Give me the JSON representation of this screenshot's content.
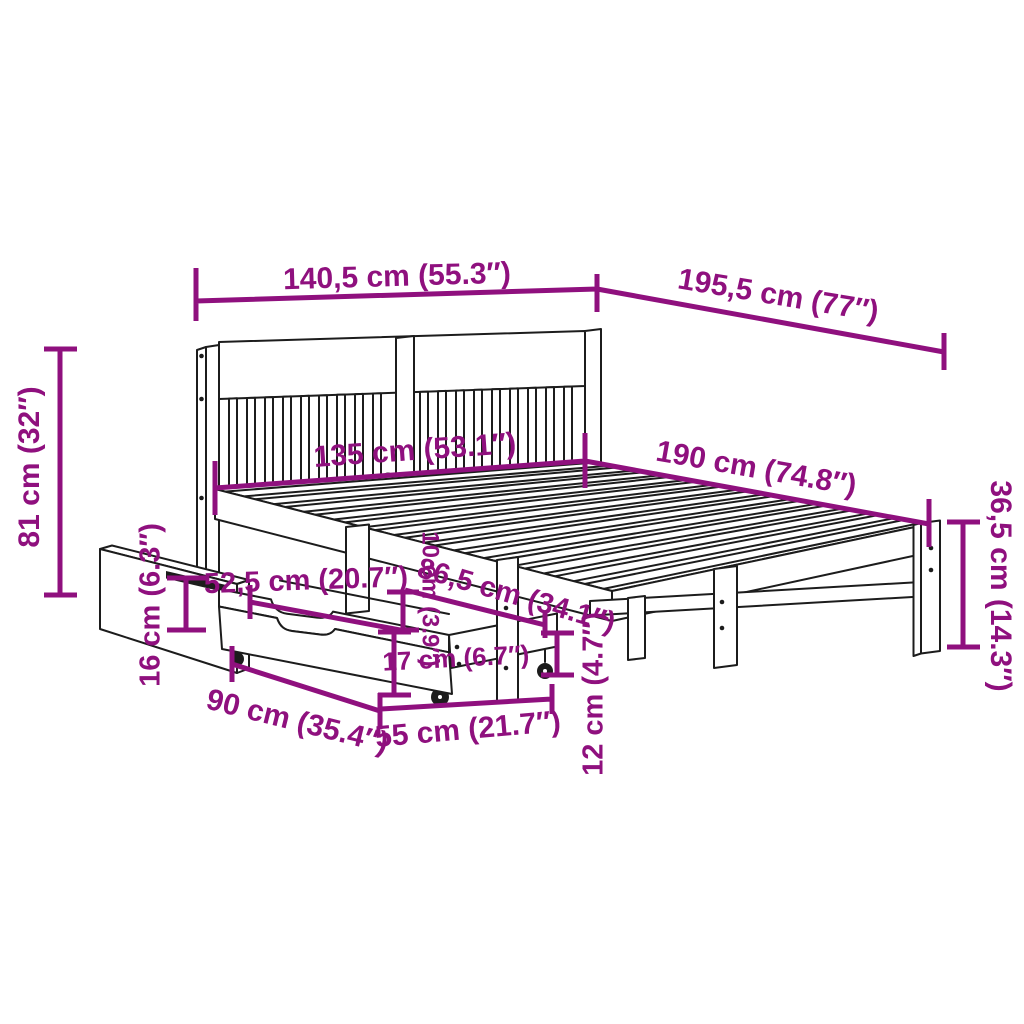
{
  "diagram": {
    "type": "product-dimension-diagram",
    "subject": "bed-frame-with-storage-drawers",
    "colors": {
      "accent": "#8F107E",
      "line_art": "#1c1c1c",
      "background": "#ffffff"
    }
  },
  "dimensions": [
    {
      "id": "total-width",
      "label": "140,5 cm (55.3″)"
    },
    {
      "id": "total-length",
      "label": "195,5 cm (77″)"
    },
    {
      "id": "headboard-height",
      "label": "81 cm (32″)"
    },
    {
      "id": "mattress-width",
      "label": "135 cm (53.1″)"
    },
    {
      "id": "mattress-length",
      "label": "190 cm (74.8″)"
    },
    {
      "id": "foot-end-height",
      "label": "36,5 cm (14.3″)"
    },
    {
      "id": "drawer-back-height",
      "label": "16 cm (6.3″)"
    },
    {
      "id": "drawer-opening-width",
      "label": "52,5 cm (20.7″)"
    },
    {
      "id": "rail-clearance",
      "label": "10 cm (3.9″)"
    },
    {
      "id": "drawer-slot-span",
      "label": "86,5 cm (34.1″)"
    },
    {
      "id": "drawer-side-height",
      "label": "17 cm (6.7″)"
    },
    {
      "id": "floor-clearance",
      "label": "12 cm (4.7″)"
    },
    {
      "id": "drawer-width",
      "label": "90 cm (35.4″)"
    },
    {
      "id": "drawer-depth",
      "label": "55 cm (21.7″)"
    }
  ]
}
